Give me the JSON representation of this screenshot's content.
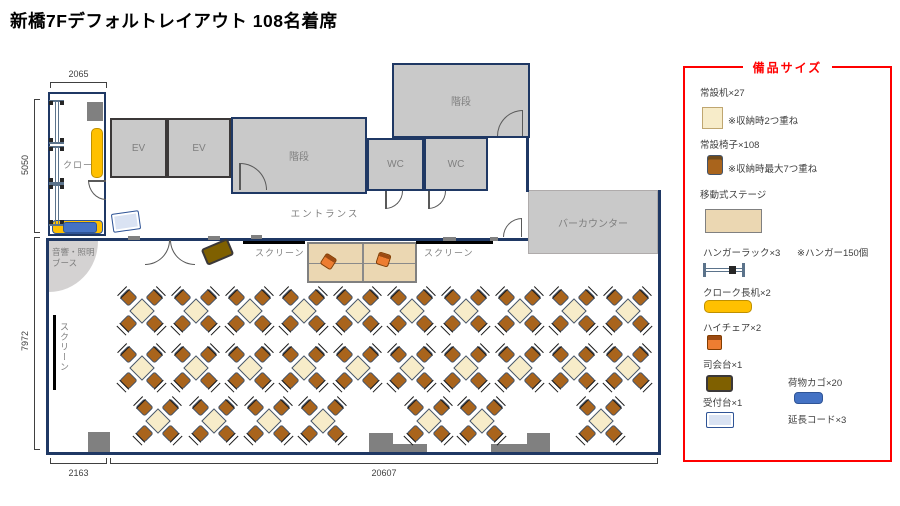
{
  "title": "新橋7Fデフォルトレイアウト 108名着席",
  "rooms": {
    "cloak_label": "クロー",
    "ev1": "EV",
    "ev2": "EV",
    "stairs_main": "階段",
    "stairs_top": "階段",
    "wc1": "WC",
    "wc2": "WC",
    "entrance": "エントランス",
    "bar_counter": "バーカウンター",
    "booth_line1": "音響・照明",
    "booth_line2": "ブース"
  },
  "screens": {
    "stage_left": "スクリーン",
    "stage_right": "スクリーン",
    "side_wall": "スクリーン"
  },
  "dimensions": {
    "cloak_width": "2065",
    "upper_height": "5050",
    "lower_height": "7972",
    "bottom_left": "2163",
    "bottom_main": "20607"
  },
  "legend": {
    "title": "備品サイズ",
    "items": [
      {
        "id": "desk",
        "label": "常設机×27",
        "note": "※収納時2つ重ね"
      },
      {
        "id": "chair",
        "label": "常設椅子×108",
        "note": "※収納時最大7つ重ね"
      },
      {
        "id": "stage",
        "label": "移動式ステージ",
        "note": ""
      },
      {
        "id": "hanger",
        "label": "ハンガーラック×3",
        "note": "※ハンガー150個"
      },
      {
        "id": "cloak_desk",
        "label": "クローク長机×2",
        "note": ""
      },
      {
        "id": "high_chair",
        "label": "ハイチェア×2",
        "note": ""
      },
      {
        "id": "mc",
        "label": "司会台×1",
        "note": ""
      },
      {
        "id": "basket",
        "label": "荷物カゴ×20",
        "note": ""
      },
      {
        "id": "reception",
        "label": "受付台×1",
        "note": ""
      },
      {
        "id": "cord",
        "label": "延長コード×3",
        "note": ""
      }
    ]
  },
  "colors": {
    "wall": "#1F3864",
    "room_fill": "#C9C9C9",
    "table": "#F7ECC9",
    "chair": "#A9641C",
    "stage": "#EBD7B2",
    "desk_yellow": "#FFC000",
    "basket_blue": "#4472C4",
    "high_chair_orange": "#ED7D31",
    "mc_olive": "#7F6000",
    "reception_blue": "#DAE3F3",
    "legend_border": "#FF0000"
  },
  "floorplan": {
    "table_rows": [
      {
        "y": 312,
        "x": [
          143,
          197,
          251,
          305,
          359,
          413,
          467,
          521,
          575,
          629
        ]
      },
      {
        "y": 369,
        "x": [
          143,
          197,
          251,
          305,
          359,
          413,
          467,
          521,
          575,
          629
        ]
      },
      {
        "y": 422,
        "x": [
          159,
          215,
          270,
          324,
          430,
          483,
          602
        ]
      }
    ],
    "pillars": [
      {
        "x": 87,
        "y": 102,
        "w": 16,
        "h": 19
      },
      {
        "x": 88,
        "y": 432,
        "w": 22,
        "h": 20
      },
      {
        "x": 369,
        "y": 433,
        "w": 24,
        "h": 19
      },
      {
        "x": 393,
        "y": 444,
        "w": 34,
        "h": 8
      },
      {
        "x": 491,
        "y": 444,
        "w": 36,
        "h": 8
      },
      {
        "x": 527,
        "y": 433,
        "w": 23,
        "h": 19
      }
    ],
    "wall_marks": [
      {
        "x": 128,
        "y": 236,
        "w": 12,
        "h": 4
      },
      {
        "x": 208,
        "y": 236,
        "w": 12,
        "h": 4
      },
      {
        "x": 251,
        "y": 235,
        "w": 11,
        "h": 4
      },
      {
        "x": 443,
        "y": 237,
        "w": 13,
        "h": 4
      },
      {
        "x": 490,
        "y": 237,
        "w": 8,
        "h": 4
      }
    ],
    "hanger_racks": [
      {
        "x": 49,
        "y": 100,
        "h": 44
      },
      {
        "x": 49,
        "y": 146,
        "h": 38
      },
      {
        "x": 49,
        "y": 184,
        "h": 42
      }
    ]
  }
}
